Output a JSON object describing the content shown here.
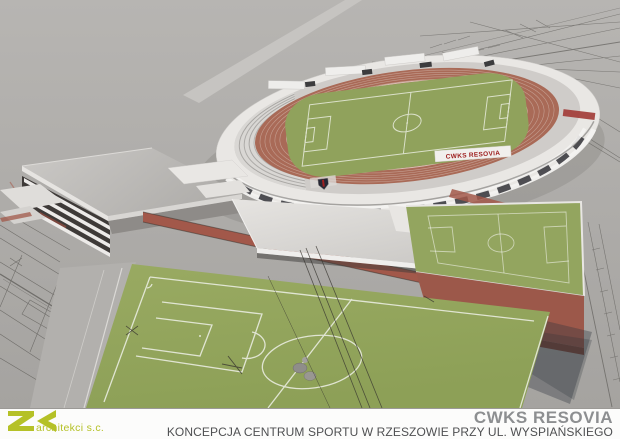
{
  "render": {
    "stadium_banner": "CWKS RESOVIA",
    "icons": {
      "crest": "resovia-crest-icon",
      "logo": "zk-logo-icon"
    }
  },
  "footer": {
    "logo_letters": "ZK",
    "logo_name": "architekci s.c.",
    "title": "CWKS RESOVIA",
    "subtitle": "KONCEPCJA CENTRUM SPORTU W RZESZOWIE PRZY UL. WYSPIAŃSKIEGO"
  },
  "colors": {
    "background_gray": "#b0aeab",
    "track_terracotta": "#a96a57",
    "pitch_green": "#93a55f",
    "walkway_red": "#a2584a",
    "banner_red": "#9e2020",
    "logo_lime": "#b5c127",
    "title_gray": "#8d8f91",
    "subtitle_gray": "#4f5052"
  }
}
